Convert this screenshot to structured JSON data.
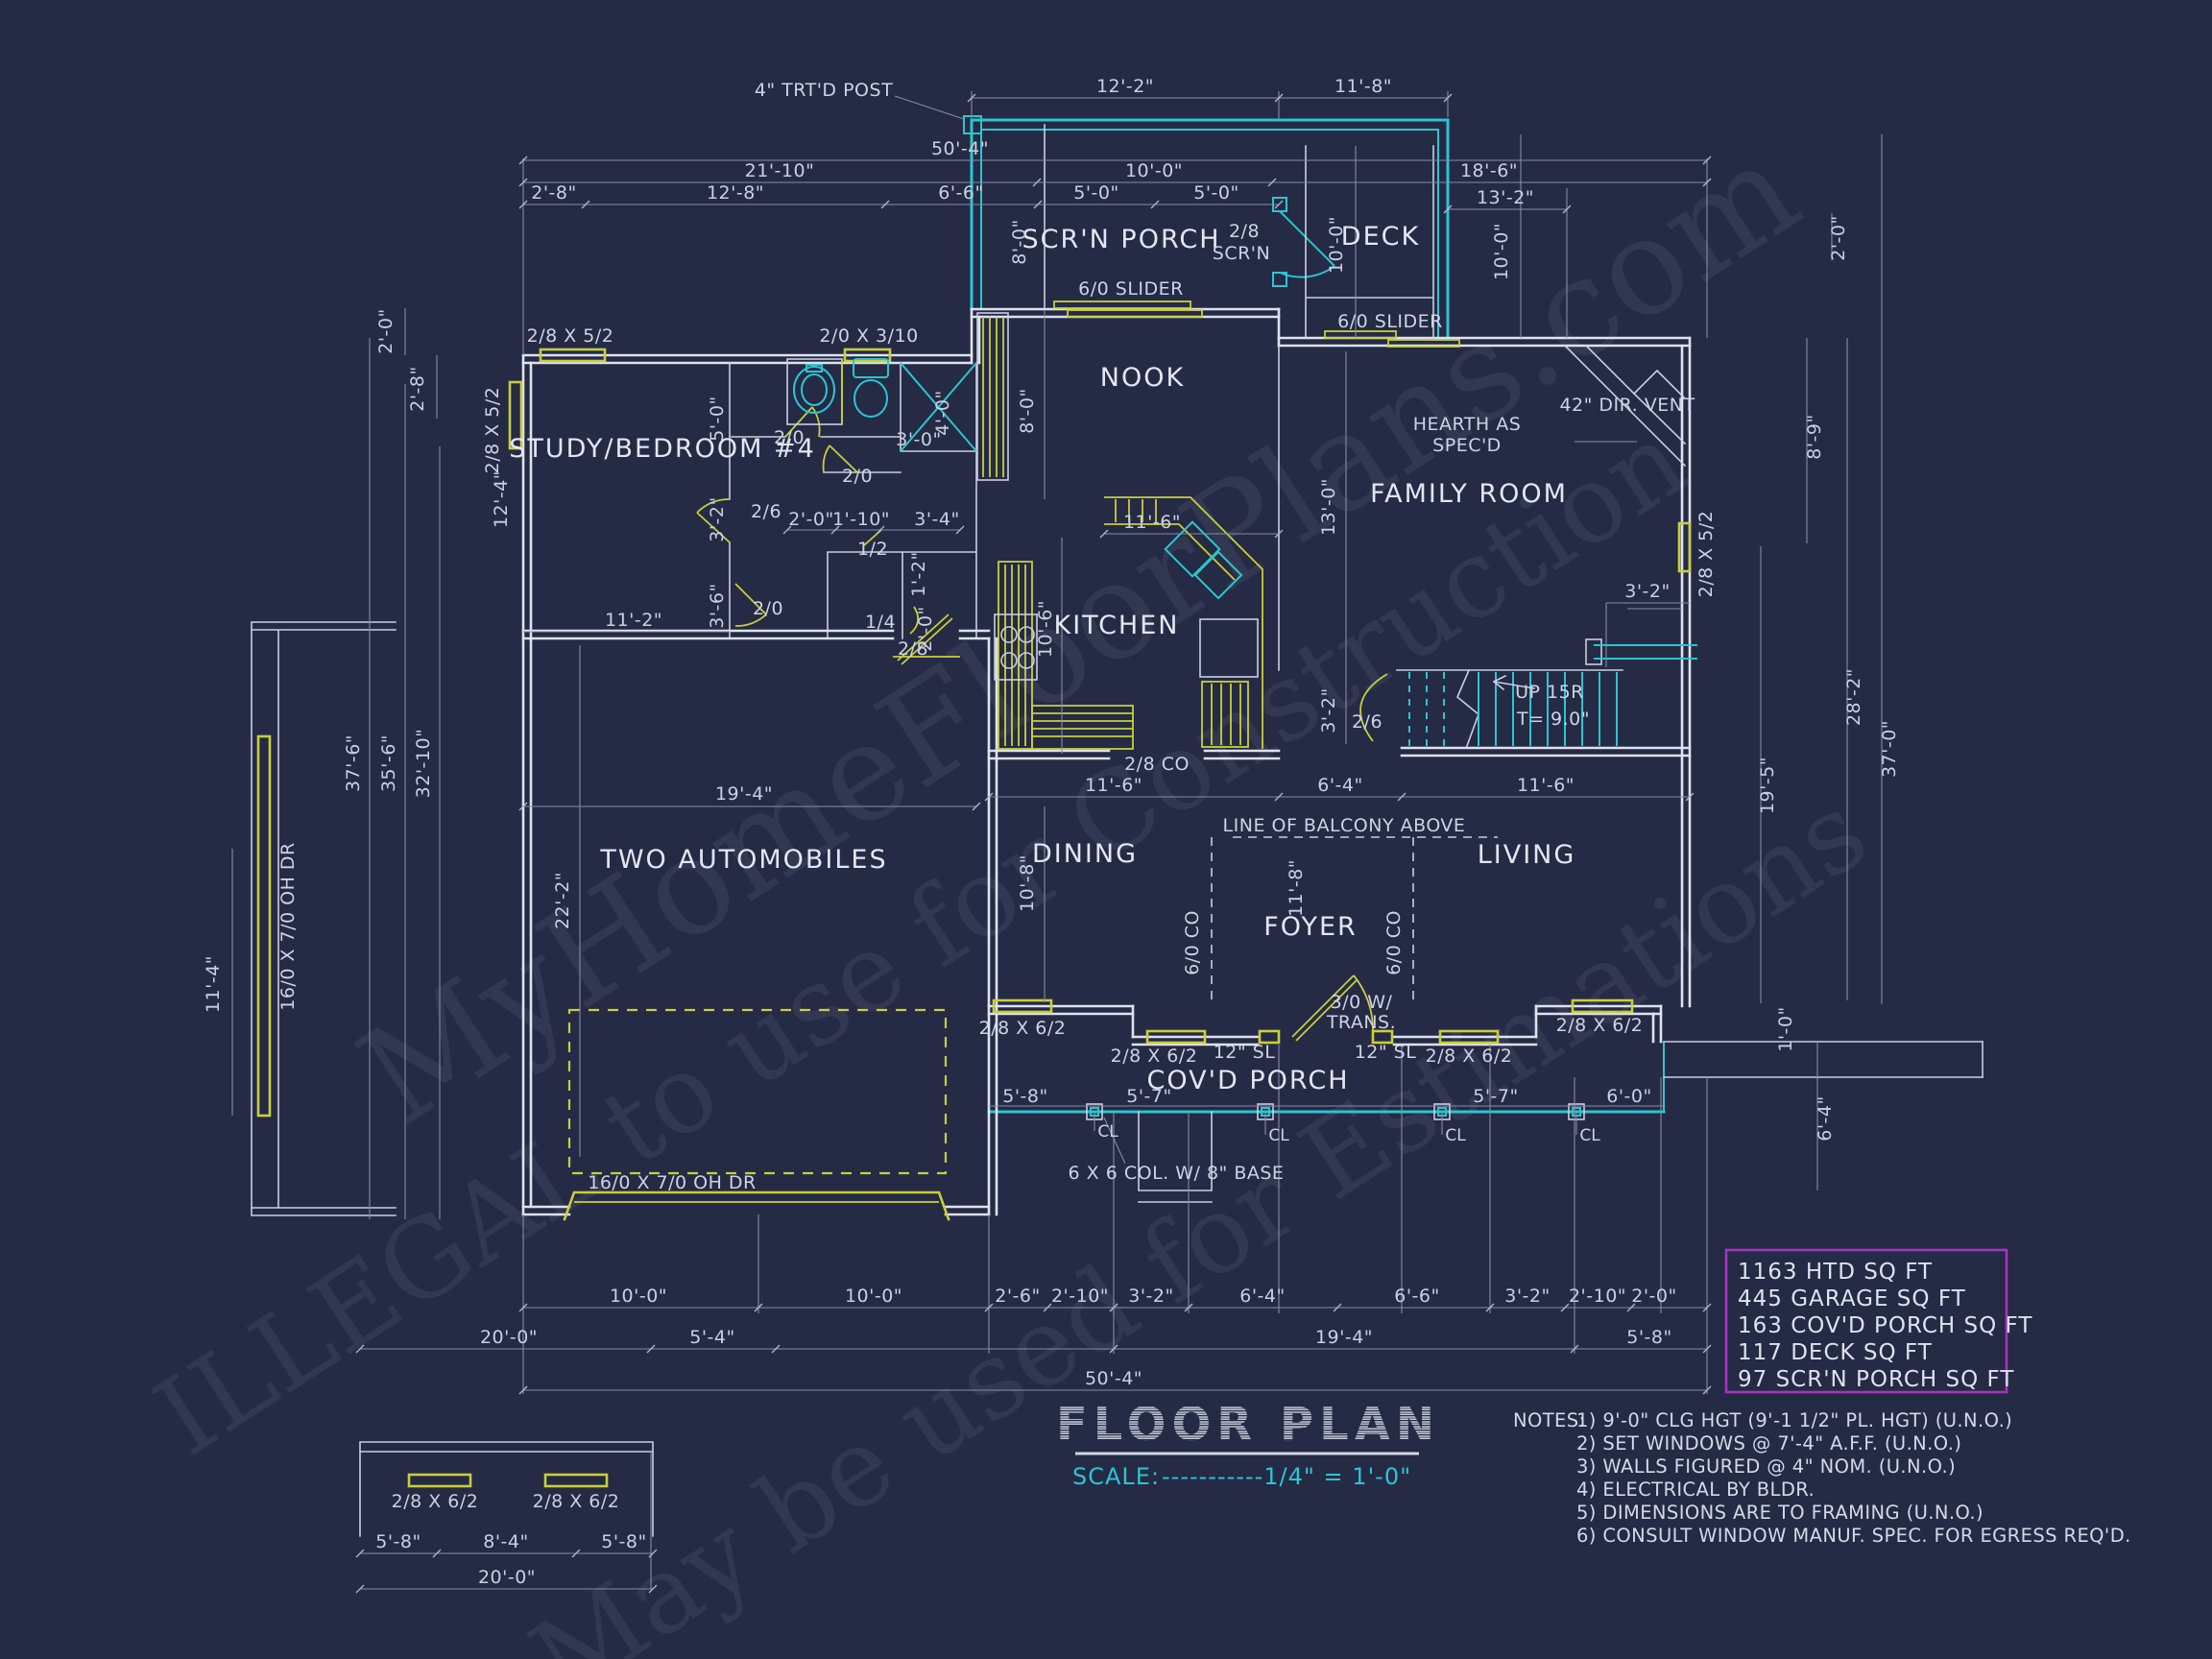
{
  "colors": {
    "background": "#252a45",
    "wall": "#dde3ef",
    "dim_line": "#848da6",
    "cyan": "#2cc5cf",
    "yellow": "#c9cf3a",
    "magenta": "#a435c0"
  },
  "title_block": {
    "title": "FLOOR PLAN",
    "scale_label": "SCALE:",
    "scale_value": "-----------1/4\" = 1'-0\""
  },
  "summary_box": {
    "lines": [
      "1163 HTD SQ FT",
      "445 GARAGE SQ FT",
      "163 COV'D PORCH SQ FT",
      "117 DECK SQ FT",
      "97 SCR'N PORCH SQ FT"
    ]
  },
  "notes": {
    "label": "NOTES:",
    "items": [
      "1)  9'-0\" CLG HGT (9'-1 1/2\" PL. HGT) (U.N.O.)",
      "2)  SET WINDOWS @ 7'-4\" A.F.F.  (U.N.O.)",
      "3)  WALLS FIGURED @ 4\" NOM. (U.N.O.)",
      "4)  ELECTRICAL BY BLDR.",
      "5)  DIMENSIONS ARE TO FRAMING (U.N.O.)",
      "6)  CONSULT WINDOW MANUF. SPEC. FOR EGRESS REQ'D."
    ]
  },
  "watermarks": {
    "w0": "MyHomeFloorPlans.com",
    "w1": "ILLEGAL to use for Construction",
    "w2": "May be used for Estimations"
  },
  "rooms": {
    "scrn_porch": "SCR'N PORCH",
    "deck": "DECK",
    "nook": "NOOK",
    "study_bedroom": "STUDY/BEDROOM #4",
    "family_room": "FAMILY ROOM",
    "kitchen": "KITCHEN",
    "dining": "DINING",
    "foyer": "FOYER",
    "living": "LIVING",
    "garage": "TWO AUTOMOBILES",
    "covd_porch": "COV'D PORCH"
  },
  "annotations": {
    "trtd_post": "4\" TRT'D POST",
    "scrn_door_line1": "2/8",
    "scrn_door_line2": "SCR'N",
    "slider_nook": "6/0 SLIDER",
    "slider_family": "6/0 SLIDER",
    "hearth_line1": "HEARTH AS",
    "hearth_line2": "SPEC'D",
    "dir_vent": "42\" DIR. VENT",
    "up_stairs": "UP 15R",
    "tread": "T= 9.0\"",
    "balcony": "LINE OF BALCONY ABOVE",
    "co_dining": "6/0 CO",
    "co_living": "6/0 CO",
    "co_kitchen": "2/8 CO",
    "sl_left": "12\" SL",
    "sl_right": "12\" SL",
    "trans_line1": "3/0 W/",
    "trans_line2": "TRANS.",
    "cl": "CL",
    "col_base": "6 X 6 COL. W/ 8\" BASE",
    "oh_door": "16/0 X 7/0 OH DR",
    "oh_door_side": "16/0 X 7/0 OH DR"
  },
  "windows": {
    "study_top": "2/8 X 5/2",
    "study_left": "2/8 X 5/2",
    "bath_top": "2/0 X 3/10",
    "family_right": "2/8 X 5/2",
    "front_dining_1": "2/8 X 6/2",
    "front_dining_2": "2/8 X 6/2",
    "front_living_1": "2/8 X 6/2",
    "front_living_2": "2/8 X 6/2"
  },
  "doors": {
    "bath": "2/0",
    "hall_upper": "2/0",
    "bedroom": "2/6",
    "linen": "1/2",
    "hall_lower": "2/0",
    "pantry": "1/4",
    "garage_entry": "2/8",
    "stair": "2/6"
  },
  "dims": {
    "top": [
      "12'-2\"",
      "11'-8\"",
      "50'-4\"",
      "21'-10\"",
      "10'-0\"",
      "18'-6\"",
      "2'-8\"",
      "12'-8\"",
      "6'-6\"",
      "5'-0\"",
      "5'-0\"",
      "13'-2\"",
      "8'-0\"",
      "10'-0\"",
      "10'-0\""
    ],
    "left": [
      "2'-0\"",
      "2'-8\"",
      "12'-4\"",
      "37'-6\"",
      "35'-6\"",
      "32'-10\"",
      "11'-4\"",
      "22'-2\"",
      "19'-4\"",
      "11'-2\"",
      "5'-0\"",
      "3'-2\"",
      "3'-6\""
    ],
    "right": [
      "2'-0\"",
      "8'-9\"",
      "28'-2\"",
      "37'-0\"",
      "19'-5\"",
      "1'-0\"",
      "6'-4\""
    ],
    "interior": [
      "3'-0\"",
      "4'-0\"",
      "2'-0\"",
      "1'-10\"",
      "3'-4\"",
      "8'-0\"",
      "11'-6\"",
      "10'-6\"",
      "1'-2\"",
      "2'-0\"",
      "13'-0\"",
      "3'-2\"",
      "3'-2\"",
      "11'-6\"",
      "6'-4\"",
      "11'-6\"",
      "10'-8\"",
      "11'-8\"",
      "5'-8\"",
      "5'-7\"",
      "5'-7\"",
      "6'-0\""
    ],
    "bottom": [
      "10'-0\"",
      "10'-0\"",
      "2'-6\"",
      "2'-10\"",
      "3'-2\"",
      "6'-4\"",
      "6'-6\"",
      "3'-2\"",
      "2'-10\"",
      "2'-0\"",
      "20'-0\"",
      "5'-4\"",
      "19'-4\"",
      "5'-8\"",
      "50'-4\""
    ],
    "detail": [
      "2/8 X 6/2",
      "2/8 X 6/2",
      "5'-8\"",
      "8'-4\"",
      "5'-8\"",
      "20'-0\""
    ]
  }
}
